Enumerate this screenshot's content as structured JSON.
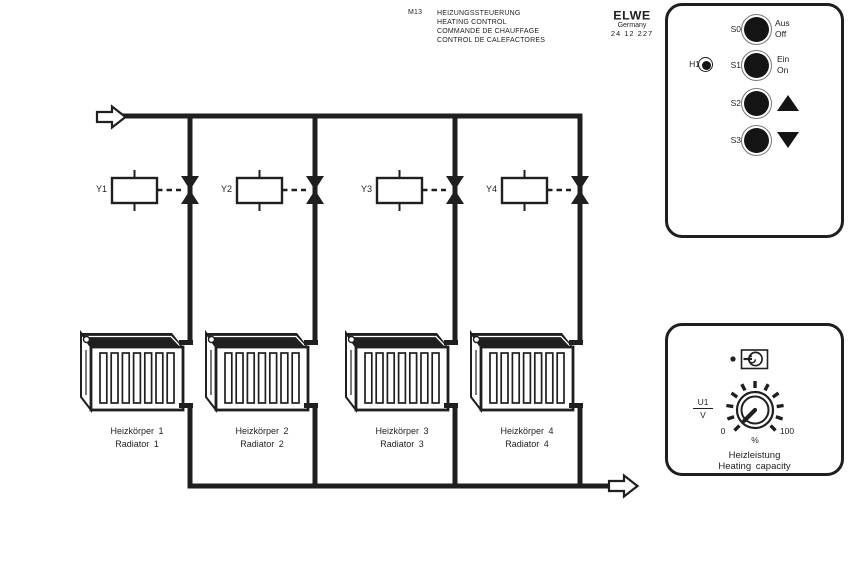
{
  "header": {
    "model": "M13",
    "title_de": "HEIZUNGSSTEUERUNG",
    "title_en": "HEATING CONTROL",
    "title_fr": "COMMANDE DE CHAUFFAGE",
    "title_es": "CONTROL DE CALEFACTORES",
    "brand": {
      "name": "ELWE",
      "country": "Germany",
      "part_number": "24 12 227"
    }
  },
  "schematic": {
    "valves": [
      {
        "label": "Y1"
      },
      {
        "label": "Y2"
      },
      {
        "label": "Y3"
      },
      {
        "label": "Y4"
      }
    ],
    "radiators": [
      {
        "label_de": "Heizkörper 1",
        "label_en": "Radiator 1"
      },
      {
        "label_de": "Heizkörper 2",
        "label_en": "Radiator 2"
      },
      {
        "label_de": "Heizkörper 3",
        "label_en": "Radiator 3"
      },
      {
        "label_de": "Heizkörper 4",
        "label_en": "Radiator 4"
      }
    ]
  },
  "control_panel": {
    "indicator_label": "H1",
    "buttons": [
      {
        "id": "S0",
        "line1": "Aus",
        "line2": "Off"
      },
      {
        "id": "S1",
        "line1": "Ein",
        "line2": "On"
      },
      {
        "id": "S2",
        "symbol": "triangle-up"
      },
      {
        "id": "S3",
        "symbol": "triangle-down"
      }
    ]
  },
  "capacity_panel": {
    "signal_numerator": "U1",
    "signal_denominator": "V",
    "scale_min": "0",
    "scale_unit": "%",
    "scale_max": "100",
    "label_de": "Heizleistung",
    "label_en": "Heating capacity"
  },
  "colors": {
    "ink": "#1f1f1f",
    "background": "#ffffff"
  }
}
